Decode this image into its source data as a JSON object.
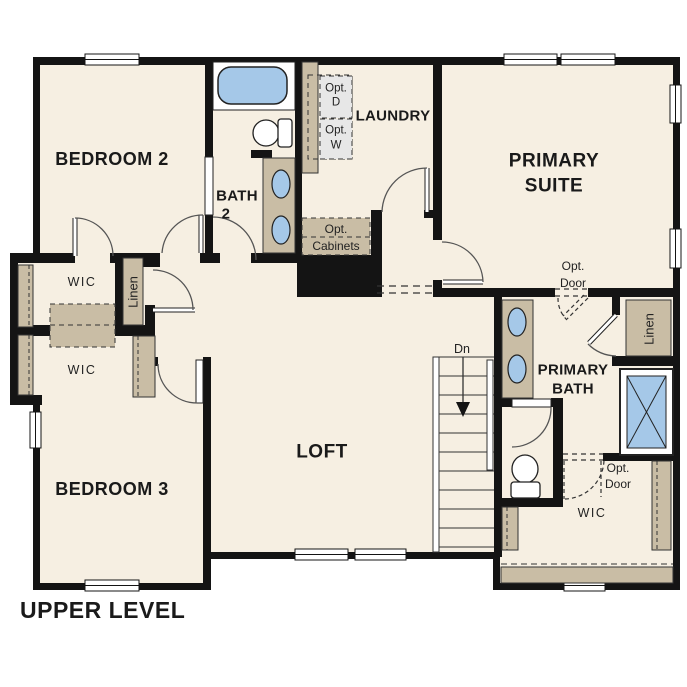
{
  "plan": {
    "title": "UPPER LEVEL",
    "rooms": {
      "bedroom2": "BEDROOM 2",
      "bedroom3": "BEDROOM 3",
      "primary_suite_line1": "PRIMARY",
      "primary_suite_line2": "SUITE",
      "loft": "LOFT",
      "laundry": "LAUNDRY",
      "bath2_line1": "BATH",
      "bath2_line2": "2",
      "primary_bath_line1": "PRIMARY",
      "primary_bath_line2": "BATH"
    },
    "closets": {
      "wic_bedroom2": "WIC",
      "wic_bedroom3": "WIC",
      "wic_primary": "WIC",
      "linen_left": "Linen",
      "linen_right": "Linen"
    },
    "annotations": {
      "opt_dryer_line1": "Opt.",
      "opt_dryer_line2": "D",
      "opt_washer_line1": "Opt.",
      "opt_washer_line2": "W",
      "opt_cabinets_line1": "Opt.",
      "opt_cabinets_line2": "Cabinets",
      "opt_door_suite_line1": "Opt.",
      "opt_door_suite_line2": "Door",
      "opt_door_wic_line1": "Opt.",
      "opt_door_wic_line2": "Door",
      "stairs_down": "Dn"
    },
    "colors": {
      "floor": "#f6efe2",
      "wall": "#141414",
      "cabinet_tan": "#c9bda5",
      "fixture_blue": "#a5c8e8",
      "optional_gray": "#e7e7e7",
      "outside": "#ffffff"
    }
  }
}
